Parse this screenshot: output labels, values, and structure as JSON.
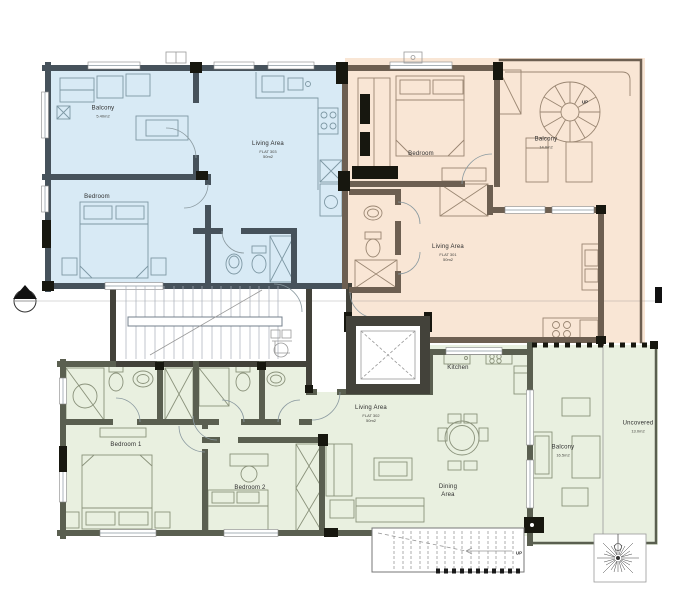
{
  "plan": {
    "type": "architectural-floor-plan",
    "labels": {
      "flat303": {
        "balcony": {
          "name": "Balcony",
          "area": "5.40m2"
        },
        "living": {
          "name": "Living Area",
          "flat": "FLAT 303",
          "area": "50m2"
        },
        "bedroom": {
          "name": "Bedroom"
        }
      },
      "flat301": {
        "bedroom": {
          "name": "Bedroom"
        },
        "balcony": {
          "name": "Balcony",
          "area": "14.0m2"
        },
        "living": {
          "name": "Living Area",
          "flat": "FLAT 301",
          "area": "50m2"
        },
        "spiral_stair_up": "UP"
      },
      "flat302": {
        "bedroom1": {
          "name": "Bedroom 1"
        },
        "bedroom2": {
          "name": "Bedroom 2"
        },
        "living": {
          "name": "Living Area",
          "flat": "FLAT 302",
          "area": "50m2"
        },
        "kitchen": {
          "name": "Kitchen"
        },
        "dining": {
          "name": "Dining Area"
        },
        "balcony": {
          "name": "Balcony",
          "area": "16.5m2"
        },
        "uncovered": {
          "name": "Uncovered",
          "area": "13.0m2"
        }
      },
      "exterior_stair_up": "UP"
    },
    "colors": {
      "flat301_fill": "#f9e6d5",
      "flat302_fill": "#e9f0e0",
      "flat303_fill": "#d8eaf5",
      "wall_blue": "#46525b",
      "wall_brown": "#6d5f51",
      "wall_green": "#5a5f50",
      "wall_core": "#43423a",
      "column_black": "#17170f"
    }
  }
}
